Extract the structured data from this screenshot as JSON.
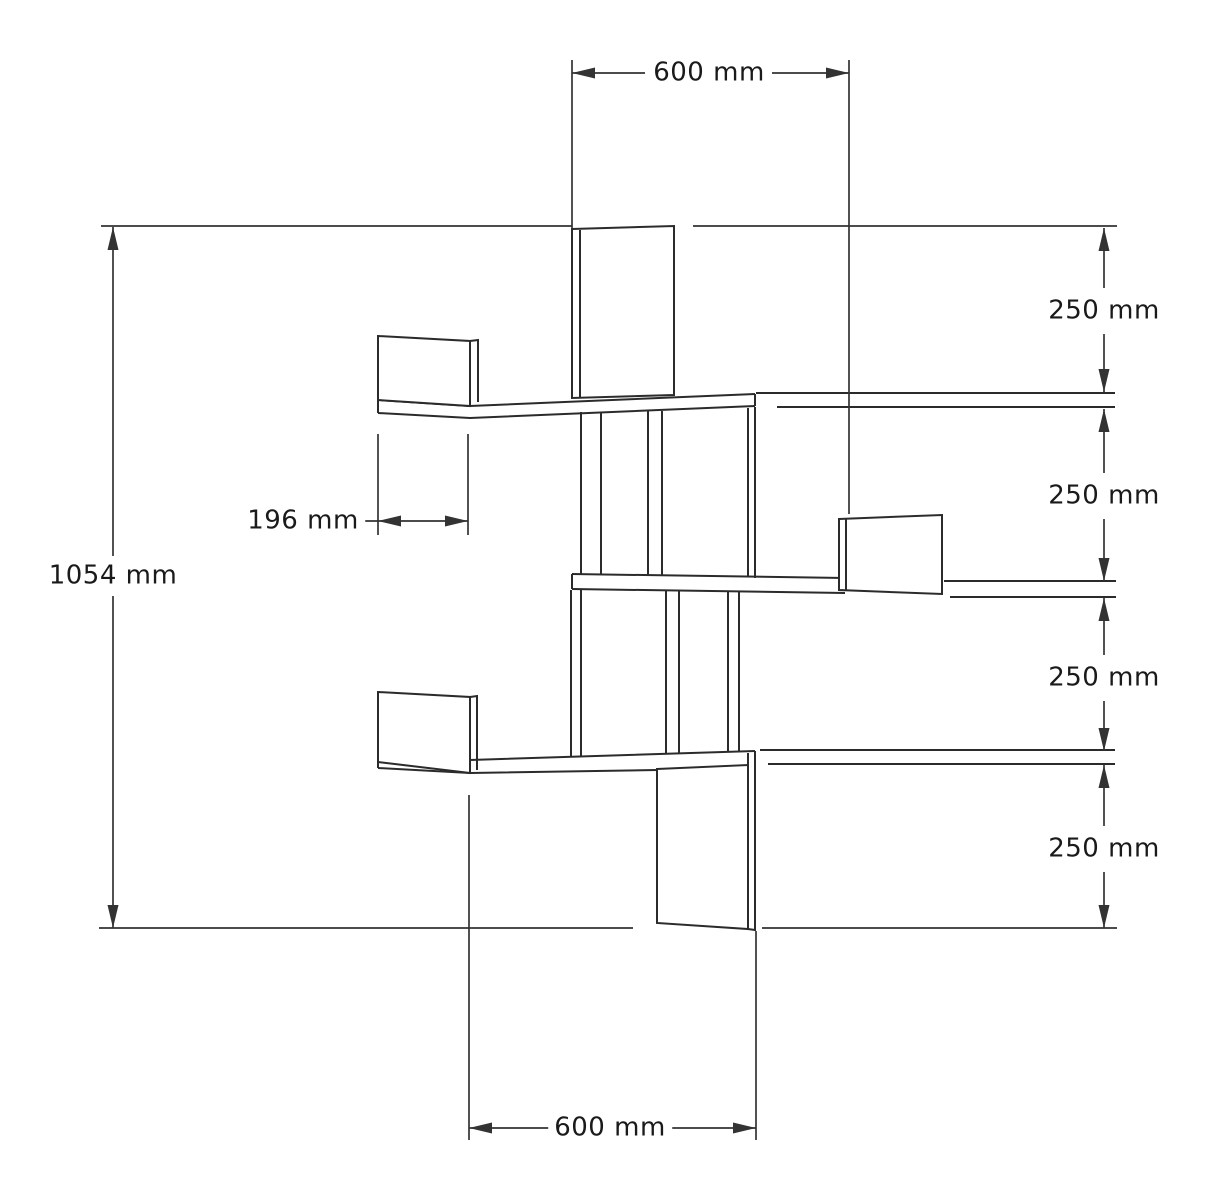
{
  "page": {
    "background": "#ffffff"
  },
  "labels": {
    "top_width": {
      "text": "600 mm",
      "x": 709,
      "y": 73
    },
    "overall_height": {
      "text": "1054 mm",
      "x": 113,
      "y": 576
    },
    "panel_width": {
      "text": "196 mm",
      "x": 303,
      "y": 521
    },
    "gap_1": {
      "text": "250 mm",
      "x": 1104,
      "y": 311
    },
    "gap_2": {
      "text": "250 mm",
      "x": 1104,
      "y": 496
    },
    "gap_3": {
      "text": "250 mm",
      "x": 1104,
      "y": 678
    },
    "gap_4": {
      "text": "250 mm",
      "x": 1104,
      "y": 849
    },
    "bottom_width": {
      "text": "600 mm",
      "x": 610,
      "y": 1128
    }
  },
  "drawing": {
    "stroke_color": "#2b2b2b",
    "dim_color": "#333333",
    "structure_width": 2,
    "dim_width": 1.7,
    "structure_paths": [
      {
        "name": "shelf-top-front-edge",
        "d": "M378,400 L470,406 L755,394"
      },
      {
        "name": "shelf-top-bottom-edge",
        "d": "M378,413 L470,418 L755,406"
      },
      {
        "name": "shelf-top-left-end",
        "d": "M378,400 L378,413"
      },
      {
        "name": "shelf-top-right-end",
        "d": "M755,394 L755,406"
      },
      {
        "name": "shelf-top-wall-line-upper",
        "d": "M756,393 L1115,393"
      },
      {
        "name": "shelf-top-wall-line-lower",
        "d": "M777,407 L1115,407"
      },
      {
        "name": "shelf-middle-top-edge",
        "d": "M572,574 L845,578"
      },
      {
        "name": "shelf-middle-bottom-edge",
        "d": "M572,589 L845,593"
      },
      {
        "name": "shelf-middle-left-end",
        "d": "M572,574 L572,589"
      },
      {
        "name": "shelf-middle-wall-line-upper",
        "d": "M944,581 L1116,581"
      },
      {
        "name": "shelf-middle-wall-line-lower",
        "d": "M950,597 L1116,597"
      },
      {
        "name": "shelf-bottom-top-edge",
        "d": "M378,755 L470,760 L755,751"
      },
      {
        "name": "shelf-bottom-bottom-edge",
        "d": "M378,768 L470,773 L657,770"
      },
      {
        "name": "shelf-bottom-left-end",
        "d": "M378,755 L378,768"
      },
      {
        "name": "shelf-bottom-right-inner",
        "d": "M748,753 L748,766"
      },
      {
        "name": "shelf-bottom-right-outer",
        "d": "M755,751 L755,931"
      },
      {
        "name": "shelf-bottom-wall-line-upper",
        "d": "M760,750 L1115,750"
      },
      {
        "name": "shelf-bottom-wall-line-lower",
        "d": "M768,764 L1115,764"
      },
      {
        "name": "support-upper-left-a",
        "d": "M581,412 L581,574"
      },
      {
        "name": "support-upper-left-b",
        "d": "M601,412 L601,574"
      },
      {
        "name": "support-upper-mid-a",
        "d": "M648,411 L648,575"
      },
      {
        "name": "support-upper-mid-b",
        "d": "M662,411 L662,575"
      },
      {
        "name": "support-upper-right-a",
        "d": "M748,408 L748,577"
      },
      {
        "name": "support-upper-right-b",
        "d": "M755,407 L755,578"
      },
      {
        "name": "support-lower-left-a",
        "d": "M571,590 L571,756"
      },
      {
        "name": "support-lower-left-b",
        "d": "M581,590 L581,756"
      },
      {
        "name": "support-lower-mid-a",
        "d": "M666,591 L666,754"
      },
      {
        "name": "support-lower-mid-b",
        "d": "M679,591 L679,753"
      },
      {
        "name": "support-lower-right-a",
        "d": "M728,591 L728,752"
      },
      {
        "name": "support-lower-right-b",
        "d": "M739,591 L739,752"
      }
    ],
    "panels": [
      {
        "name": "panel-top-back",
        "points": "572,229 674,226 674,395 572,398"
      },
      {
        "name": "panel-top-left-side",
        "points": "378,336 470,341 470,406 378,400"
      },
      {
        "name": "panel-middle-right-side",
        "points": "839,519 942,515 942,594 839,590"
      },
      {
        "name": "panel-bottom-left-side",
        "points": "378,692 470,697 470,773 378,762"
      },
      {
        "name": "panel-bottom-back",
        "points": "657,769 748,765 748,929 657,923"
      }
    ],
    "panel_edge_paths": [
      {
        "name": "panel-top-back-thickness-edge",
        "d": "M580,230 L580,397"
      },
      {
        "name": "panel-top-left-side-thickness-edge",
        "d": "M470,341 L478,340 L478,402"
      },
      {
        "name": "panel-middle-right-side-thickness-edge",
        "d": "M846,519 L846,591"
      },
      {
        "name": "panel-bottom-left-side-thickness-edge",
        "d": "M470,697 L477,696 L477,770"
      },
      {
        "name": "panel-bottom-back-bottom-step",
        "d": "M748,929 L755,930"
      }
    ],
    "dim_paths": [
      {
        "name": "dim-ext-top-left",
        "d": "M572,60 L572,229"
      },
      {
        "name": "dim-ext-top-right",
        "d": "M849,60 L849,514"
      },
      {
        "name": "dim-line-top-a",
        "d": "M572,73 L645,73"
      },
      {
        "name": "dim-line-top-b",
        "d": "M772,73 L849,73"
      },
      {
        "name": "dim-ext-upper-left",
        "d": "M101,226 L572,226"
      },
      {
        "name": "dim-ext-upper-right",
        "d": "M693,226 L1117,226"
      },
      {
        "name": "dim-line-height-a",
        "d": "M113,227 L113,556"
      },
      {
        "name": "dim-line-height-b",
        "d": "M113,596 L113,928"
      },
      {
        "name": "dim-ext-lower-left",
        "d": "M99,928 L633,928"
      },
      {
        "name": "dim-ext-lower-right",
        "d": "M762,928 L1117,928"
      },
      {
        "name": "dim-ext-196-left",
        "d": "M378,434 L378,535"
      },
      {
        "name": "dim-ext-196-right",
        "d": "M468,434 L468,535"
      },
      {
        "name": "dim-line-196",
        "d": "M361,521 L468,521"
      },
      {
        "name": "dim-line-right-1a",
        "d": "M1104,228 L1104,288"
      },
      {
        "name": "dim-line-right-1b",
        "d": "M1104,334 L1104,392"
      },
      {
        "name": "dim-line-right-2a",
        "d": "M1104,409 L1104,473"
      },
      {
        "name": "dim-line-right-2b",
        "d": "M1104,519 L1104,581"
      },
      {
        "name": "dim-line-right-3a",
        "d": "M1104,598 L1104,655"
      },
      {
        "name": "dim-line-right-3b",
        "d": "M1104,701 L1104,751"
      },
      {
        "name": "dim-line-right-4a",
        "d": "M1104,765 L1104,826"
      },
      {
        "name": "dim-line-right-4b",
        "d": "M1104,872 L1104,928"
      },
      {
        "name": "dim-ext-bottom-left",
        "d": "M469,795 L469,1140"
      },
      {
        "name": "dim-ext-bottom-right",
        "d": "M756,931 L756,1140"
      },
      {
        "name": "dim-line-bottom-a",
        "d": "M469,1128 L552,1128"
      },
      {
        "name": "dim-line-bottom-b",
        "d": "M668,1128 L756,1128"
      }
    ],
    "arrows": [
      {
        "name": "arrowhead-top-left",
        "x": 572,
        "y": 73,
        "dir": "left"
      },
      {
        "name": "arrowhead-top-right",
        "x": 849,
        "y": 73,
        "dir": "right"
      },
      {
        "name": "arrowhead-height-top",
        "x": 113,
        "y": 227,
        "dir": "up"
      },
      {
        "name": "arrowhead-height-bottom",
        "x": 113,
        "y": 928,
        "dir": "down"
      },
      {
        "name": "arrowhead-196-left",
        "x": 378,
        "y": 521,
        "dir": "left"
      },
      {
        "name": "arrowhead-196-right",
        "x": 468,
        "y": 521,
        "dir": "right"
      },
      {
        "name": "arrowhead-gap1-up",
        "x": 1104,
        "y": 228,
        "dir": "up"
      },
      {
        "name": "arrowhead-gap1-down",
        "x": 1104,
        "y": 392,
        "dir": "down"
      },
      {
        "name": "arrowhead-gap2-up",
        "x": 1104,
        "y": 409,
        "dir": "up"
      },
      {
        "name": "arrowhead-gap2-down",
        "x": 1104,
        "y": 581,
        "dir": "down"
      },
      {
        "name": "arrowhead-gap3-up",
        "x": 1104,
        "y": 598,
        "dir": "up"
      },
      {
        "name": "arrowhead-gap3-down",
        "x": 1104,
        "y": 751,
        "dir": "down"
      },
      {
        "name": "arrowhead-gap4-up",
        "x": 1104,
        "y": 765,
        "dir": "up"
      },
      {
        "name": "arrowhead-gap4-down",
        "x": 1104,
        "y": 928,
        "dir": "down"
      },
      {
        "name": "arrowhead-bottom-left",
        "x": 469,
        "y": 1128,
        "dir": "left"
      },
      {
        "name": "arrowhead-bottom-right",
        "x": 756,
        "y": 1128,
        "dir": "right"
      }
    ]
  }
}
